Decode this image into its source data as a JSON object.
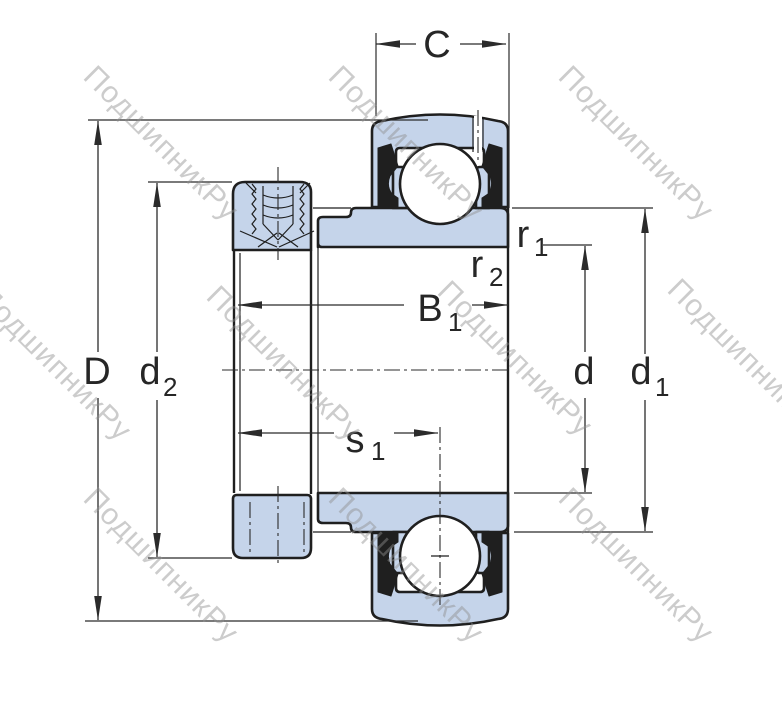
{
  "title": "bearing-cross-section-drawing",
  "watermark": {
    "text": "ПодшипникРу"
  },
  "colors": {
    "part_fill": "#c5d4ea",
    "outline": "#1f1f1f",
    "dim_line": "#2b2b2b",
    "watermark": "#8f8f8f"
  },
  "labels": {
    "C": {
      "main": "C"
    },
    "D": {
      "main": "D"
    },
    "d2": {
      "main": "d",
      "sub": "2"
    },
    "B1": {
      "main": "B",
      "sub": "1"
    },
    "s1": {
      "main": "s",
      "sub": "1"
    },
    "d": {
      "main": "d"
    },
    "d1": {
      "main": "d",
      "sub": "1"
    },
    "r1": {
      "main": "r",
      "sub": "1"
    },
    "r2": {
      "main": "r",
      "sub": "2"
    }
  }
}
